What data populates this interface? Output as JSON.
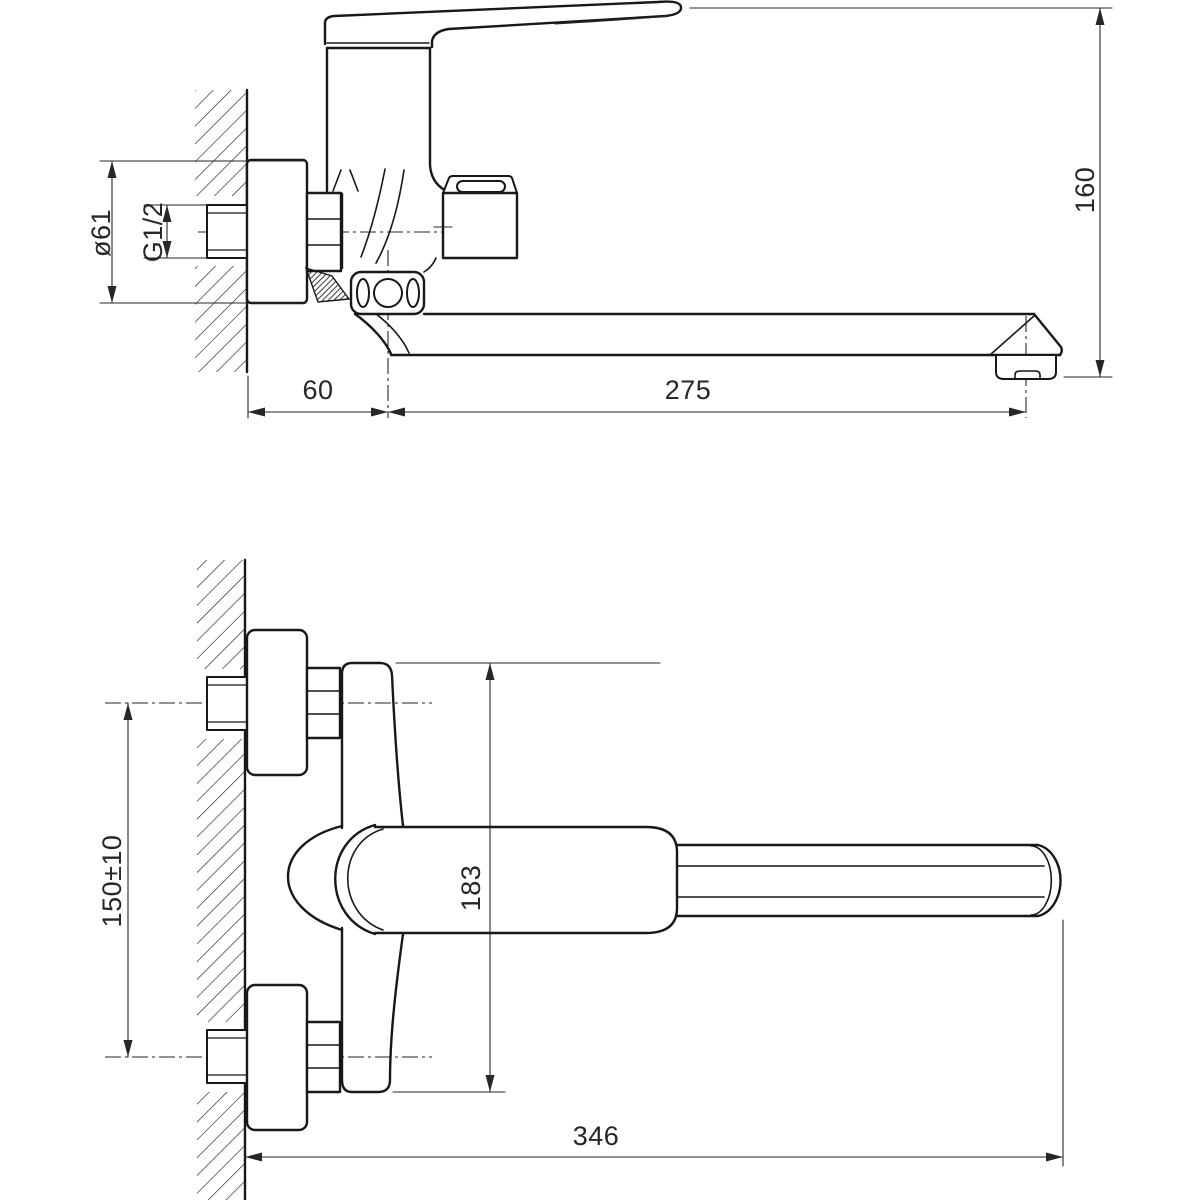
{
  "colors": {
    "line": "#17171c",
    "dimension": "#26262b",
    "background": "#ffffff"
  },
  "side_view": {
    "dims": {
      "flange_diameter": "ø61",
      "thread_size": "G1/2",
      "spout_offset": "60",
      "spout_reach": "275",
      "total_height": "160"
    }
  },
  "front_view": {
    "dims": {
      "mounting_centers": "150±10",
      "body_height": "183",
      "overall_length": "346"
    }
  }
}
